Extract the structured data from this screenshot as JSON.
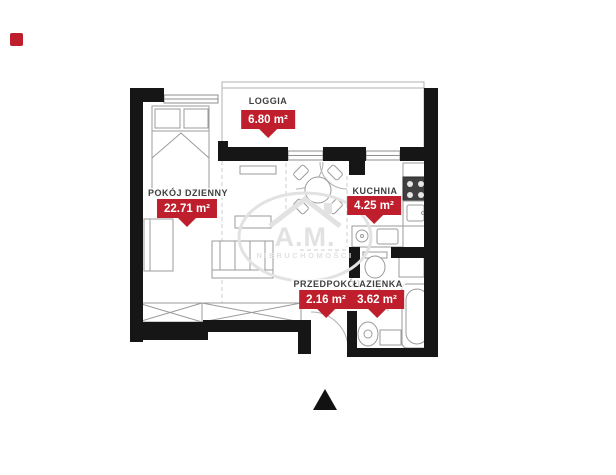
{
  "colors": {
    "tag_red": "#bf1f2c",
    "wall_black": "#161616",
    "furniture_line": "#9b9b9b",
    "light_line": "#b2b2b2",
    "dashed_line": "#cccccc",
    "label_text": "#3f3f3f",
    "watermark_gray": "#e2e2e2"
  },
  "rooms": [
    {
      "name": "LOGGIA",
      "area": "6.80 m²"
    },
    {
      "name": "POKÓJ DZIENNY",
      "area": "22.71 m²"
    },
    {
      "name": "KUCHNIA",
      "area": "4.25 m²"
    },
    {
      "name": "PRZEDPOKÓJ",
      "area": "2.16 m²"
    },
    {
      "name": "ŁAZIENKA",
      "area": "3.62 m²"
    }
  ],
  "watermark": {
    "title": "A.M.",
    "subtitle": "NIERUCHOMOŚCI"
  },
  "compass": {
    "icon": "north-arrow",
    "symbol": "▲"
  }
}
